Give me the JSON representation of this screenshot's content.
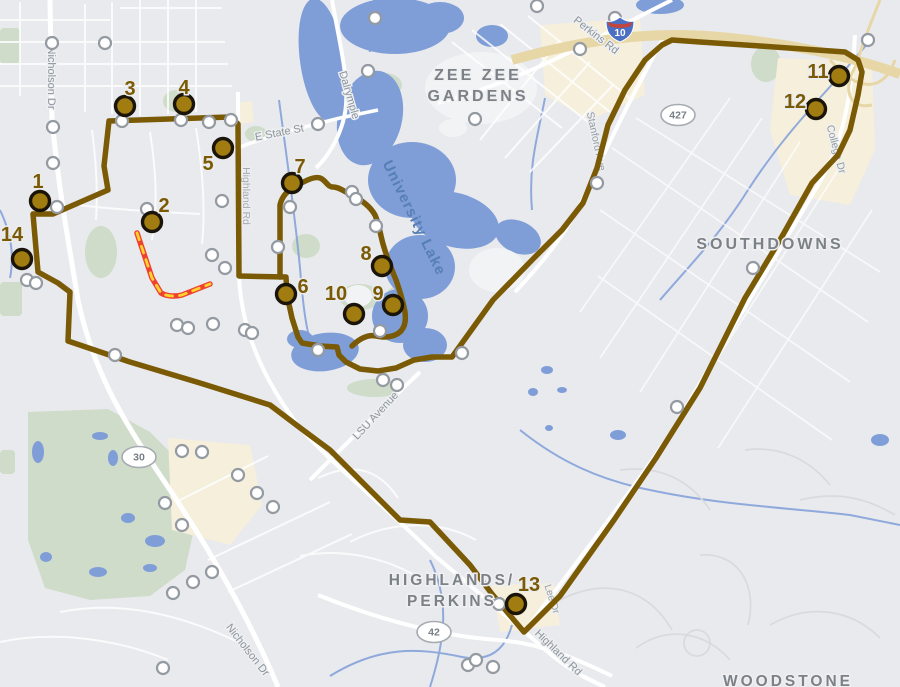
{
  "map_title": "Campus transit route map",
  "colors": {
    "background": "#e9eaee",
    "route": "#7a5a05",
    "marker_fill": "#a17c10",
    "marker_ring": "#1a1409",
    "closed_segment_red": "#ef4130",
    "closed_segment_dash_yellow": "#ffd22e",
    "water": "#7f9ed8",
    "park": "#cfdcc9",
    "commercial": "#f5efdc",
    "road": "#ffffff",
    "highway_tan": "#e7d7a6",
    "stop_fill": "#ffffff",
    "stop_ring": "#949aa1",
    "label_gray": "#7c8187",
    "street_gray": "#8d949c",
    "water_label": "#567fb4"
  },
  "numbered_stops": [
    {
      "n": "1",
      "x": 40,
      "y": 201,
      "lx": 38,
      "ly": 188
    },
    {
      "n": "2",
      "x": 152,
      "y": 222,
      "lx": 164,
      "ly": 212
    },
    {
      "n": "3",
      "x": 125,
      "y": 106,
      "lx": 130,
      "ly": 95
    },
    {
      "n": "4",
      "x": 184,
      "y": 104,
      "lx": 184,
      "ly": 94
    },
    {
      "n": "5",
      "x": 223,
      "y": 148,
      "lx": 208,
      "ly": 170
    },
    {
      "n": "6",
      "x": 286,
      "y": 294,
      "lx": 303,
      "ly": 293
    },
    {
      "n": "7",
      "x": 292,
      "y": 183,
      "lx": 300,
      "ly": 173
    },
    {
      "n": "8",
      "x": 382,
      "y": 266,
      "lx": 366,
      "ly": 260
    },
    {
      "n": "9",
      "x": 393,
      "y": 305,
      "lx": 378,
      "ly": 300
    },
    {
      "n": "10",
      "x": 354,
      "y": 314,
      "lx": 336,
      "ly": 300
    },
    {
      "n": "11",
      "x": 839,
      "y": 76,
      "lx": 818,
      "ly": 78
    },
    {
      "n": "12",
      "x": 816,
      "y": 109,
      "lx": 795,
      "ly": 108
    },
    {
      "n": "13",
      "x": 516,
      "y": 604,
      "lx": 529,
      "ly": 591
    },
    {
      "n": "14",
      "x": 22,
      "y": 259,
      "lx": 12,
      "ly": 241
    }
  ],
  "minor_stops": [
    [
      52,
      43
    ],
    [
      105,
      43
    ],
    [
      375,
      18
    ],
    [
      537,
      6
    ],
    [
      615,
      18
    ],
    [
      580,
      49
    ],
    [
      368,
      71
    ],
    [
      475,
      119
    ],
    [
      318,
      124
    ],
    [
      53,
      127
    ],
    [
      53,
      163
    ],
    [
      122,
      121
    ],
    [
      181,
      120
    ],
    [
      209,
      122
    ],
    [
      231,
      120
    ],
    [
      57,
      207
    ],
    [
      147,
      209
    ],
    [
      222,
      201
    ],
    [
      290,
      207
    ],
    [
      212,
      255
    ],
    [
      225,
      268
    ],
    [
      278,
      247
    ],
    [
      27,
      280
    ],
    [
      36,
      283
    ],
    [
      352,
      192
    ],
    [
      356,
      199
    ],
    [
      376,
      226
    ],
    [
      597,
      183
    ],
    [
      462,
      353
    ],
    [
      245,
      330
    ],
    [
      252,
      333
    ],
    [
      318,
      350
    ],
    [
      380,
      331
    ],
    [
      383,
      380
    ],
    [
      397,
      385
    ],
    [
      115,
      355
    ],
    [
      177,
      325
    ],
    [
      188,
      328
    ],
    [
      213,
      324
    ],
    [
      182,
      451
    ],
    [
      202,
      452
    ],
    [
      238,
      475
    ],
    [
      257,
      493
    ],
    [
      273,
      507
    ],
    [
      165,
      503
    ],
    [
      182,
      525
    ],
    [
      212,
      572
    ],
    [
      193,
      582
    ],
    [
      173,
      593
    ],
    [
      163,
      668
    ],
    [
      468,
      665
    ],
    [
      476,
      660
    ],
    [
      493,
      667
    ],
    [
      499,
      604
    ],
    [
      753,
      268
    ],
    [
      677,
      407
    ],
    [
      868,
      40
    ]
  ],
  "neighborhoods": [
    {
      "lines": [
        "ZEE ZEE",
        "GARDENS"
      ],
      "x": 478,
      "y": 80,
      "lh": 21,
      "size": 16
    },
    {
      "lines": [
        "SOUTHDOWNS"
      ],
      "x": 770,
      "y": 249,
      "lh": 20,
      "size": 16
    },
    {
      "lines": [
        "HIGHLANDS/",
        "PERKINS"
      ],
      "x": 452,
      "y": 585,
      "lh": 21,
      "size": 15.5
    },
    {
      "lines": [
        "WOODSTONE"
      ],
      "x": 788,
      "y": 686,
      "lh": 20,
      "size": 15.5
    }
  ],
  "water_labels": [
    {
      "text": "University Lake",
      "x": 410,
      "y": 220,
      "rot": 64,
      "size": 15
    }
  ],
  "street_labels": [
    {
      "t": "Nicholson Dr",
      "x": 48,
      "y": 78,
      "r": 90,
      "s": 11,
      "o": 1
    },
    {
      "t": "Nicholson Dr",
      "x": 245,
      "y": 652,
      "r": 52,
      "s": 11,
      "o": 1
    },
    {
      "t": "Dalrymple",
      "x": 346,
      "y": 96,
      "r": 74,
      "s": 11,
      "o": 1
    },
    {
      "t": "E State St",
      "x": 280,
      "y": 136,
      "r": -11,
      "s": 11,
      "o": 1
    },
    {
      "t": "Perkins Rd",
      "x": 594,
      "y": 38,
      "r": 38,
      "s": 11,
      "o": 1
    },
    {
      "t": "Stanford Ave",
      "x": 593,
      "y": 142,
      "r": 78,
      "s": 10.5,
      "o": 0.9
    },
    {
      "t": "College Dr",
      "x": 833,
      "y": 150,
      "r": 75,
      "s": 10.5,
      "o": 0.9
    },
    {
      "t": "Highland Rd",
      "x": 243,
      "y": 196,
      "r": 90,
      "s": 10.5,
      "o": 0.75
    },
    {
      "t": "LSU Avenue",
      "x": 378,
      "y": 418,
      "r": -47,
      "s": 11,
      "o": 1
    },
    {
      "t": "Highland Rd",
      "x": 556,
      "y": 655,
      "r": 44,
      "s": 11,
      "o": 1
    },
    {
      "t": "Lee Dr",
      "x": 549,
      "y": 600,
      "r": 72,
      "s": 10,
      "o": 0.85
    }
  ],
  "shields": {
    "interstate": [
      {
        "text": "10",
        "x": 620,
        "y": 29
      }
    ],
    "oval": [
      {
        "text": "427",
        "x": 678,
        "y": 115
      },
      {
        "text": "30",
        "x": 139,
        "y": 457
      },
      {
        "text": "42",
        "x": 434,
        "y": 632
      }
    ]
  }
}
